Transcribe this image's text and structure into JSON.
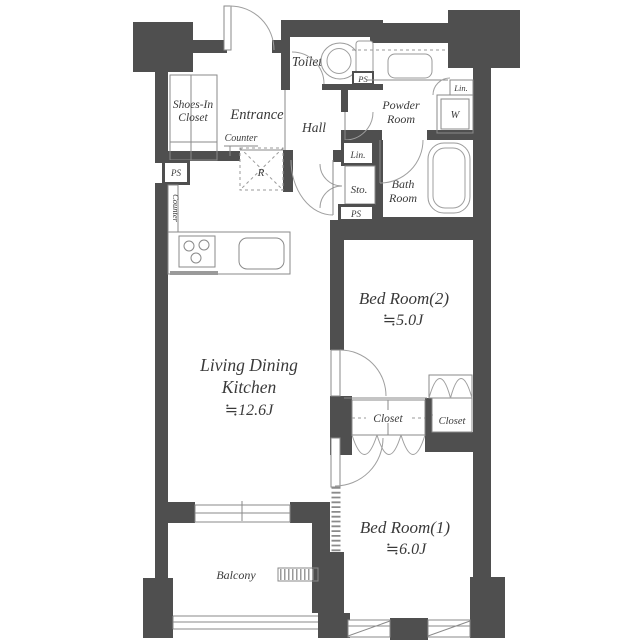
{
  "rooms": {
    "ldk": {
      "line1": "Living Dining",
      "line2": "Kitchen",
      "area": "≒12.6J"
    },
    "bedroom2": {
      "name": "Bed Room(2)",
      "area": "≒5.0J"
    },
    "bedroom1": {
      "name": "Bed Room(1)",
      "area": "≒6.0J"
    },
    "entrance": {
      "name": "Entrance"
    },
    "hall": {
      "name": "Hall"
    },
    "toilet": {
      "name": "Toilet"
    },
    "powder_room": {
      "line1": "Powder",
      "line2": "Room"
    },
    "bath_room": {
      "line1": "Bath",
      "line2": "Room"
    },
    "shoes_in_closet": {
      "line1": "Shoes-In",
      "line2": "Closet"
    },
    "storage": {
      "name": "Sto."
    },
    "balcony": {
      "name": "Balcony"
    },
    "closet1": {
      "name": "Closet"
    },
    "closet2": {
      "name": "Closet"
    }
  },
  "labels": {
    "pipe_space": "PS",
    "linen": "Lin.",
    "washer": "W",
    "counter": "Counter",
    "refrigerator": "R"
  },
  "colors": {
    "wall": "#4f4f4f",
    "thin_line": "#8a8a8a",
    "text": "#3a3a3a",
    "background": "#ffffff"
  }
}
